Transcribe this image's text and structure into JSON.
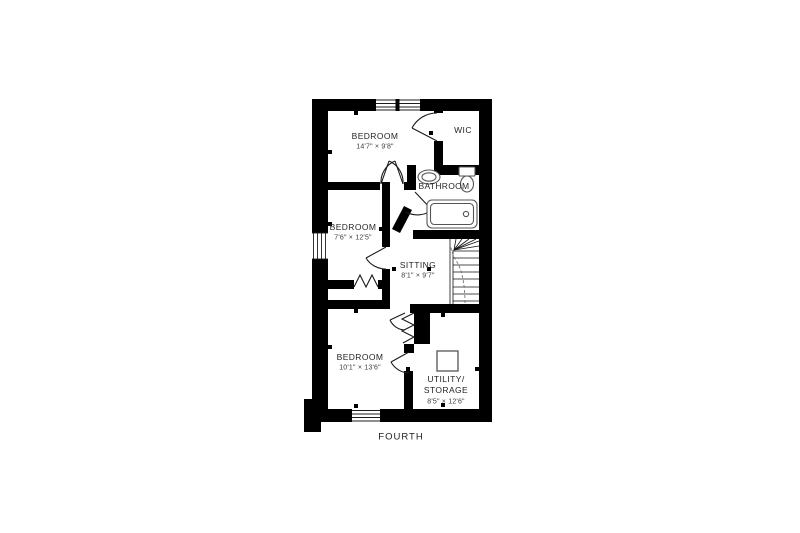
{
  "floor_plan": {
    "floor_label": "FOURTH",
    "rooms": {
      "bedroom_top": {
        "name": "BEDROOM",
        "dims": "14'7\" × 9'8\""
      },
      "wic": {
        "name": "WIC"
      },
      "bathroom": {
        "name": "BATHROOM"
      },
      "bedroom_mid": {
        "name": "BEDROOM",
        "dims": "7'6\" × 12'5\""
      },
      "sitting": {
        "name": "SITTING",
        "dims": "8'1\" × 9'7\""
      },
      "bedroom_bottom": {
        "name": "BEDROOM",
        "dims": "10'1\" × 13'6\""
      },
      "utility": {
        "name_line1": "UTILITY/",
        "name_line2": "STORAGE",
        "dims": "8'5\" × 12'6\""
      }
    },
    "fixtures": [
      "staircase",
      "bathtub",
      "toilet",
      "sink",
      "appliance-square",
      "bifold-door",
      "accordion-door",
      "window"
    ],
    "colors": {
      "wall": "#000000",
      "background": "#ffffff",
      "label_text": "#262626",
      "fixture_line": "#555555"
    }
  }
}
